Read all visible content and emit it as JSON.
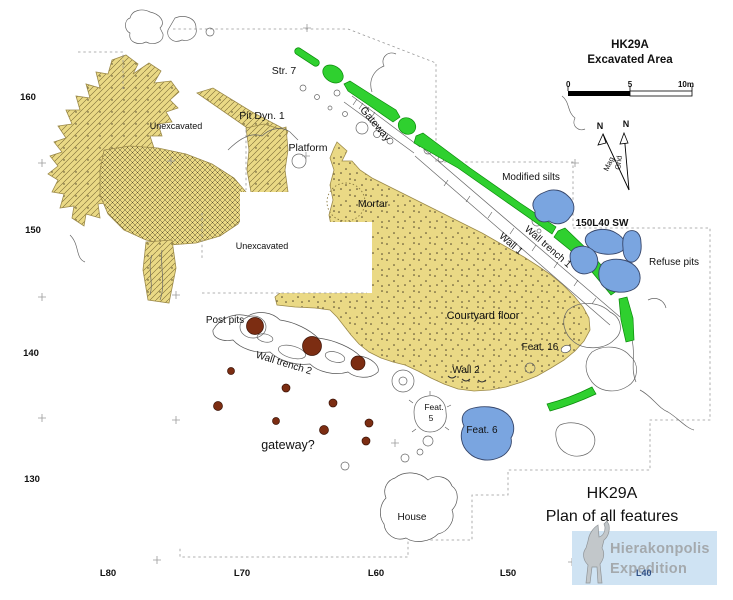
{
  "map_header": {
    "title1": "HK29A",
    "title2": "Excavated Area"
  },
  "scale_bar": {
    "t0": "0",
    "t5": "5",
    "t10": "10m"
  },
  "compass": {
    "n_mag": "N",
    "n_grid": "N",
    "mag_label": "Mag",
    "grid_label": "Grid"
  },
  "axis": {
    "rows": [
      "160",
      "150",
      "140",
      "130"
    ],
    "cols": [
      "L80",
      "L70",
      "L60",
      "L50"
    ],
    "overlay_col": "L40"
  },
  "labels": {
    "str7": "Str. 7",
    "pit_dyn1": "Pit Dyn. 1",
    "unexcavated1": "Unexcavated",
    "unexcavated2": "Unexcavated",
    "gateway": "Gateway",
    "platform": "Platform",
    "mortar": "Mortar",
    "modified_silts": "Modified silts",
    "wall1": "Wall 1",
    "wall_trench1": "Wall trench 1",
    "grid_150l40": "150L40 SW",
    "refuse_pits": "Refuse pits",
    "courtyard_floor": "Courtyard floor",
    "feat16": "Feat. 16",
    "wall2": "Wall 2",
    "post_pits": "Post pits",
    "wall_trench2": "Wall trench 2",
    "gateway_q": "gateway?",
    "feat5_line1": "Feat.",
    "feat5_line2": "5",
    "feat6": "Feat. 6",
    "house": "House"
  },
  "title_block": {
    "line1": "HK29A",
    "line2": "Plan of all features"
  },
  "logo": {
    "line1": "Hierakonpolis",
    "line2": "Expedition"
  },
  "colors": {
    "excavated_tan": "#ead985",
    "wall_green": "#2fd02f",
    "silt_blue": "#7aa5e0",
    "post_pit_brown": "#7c2d12",
    "logo_bg": "#cfe3f3",
    "logo_text": "#a4a9ad",
    "l40_blue": "#2e4f86"
  }
}
